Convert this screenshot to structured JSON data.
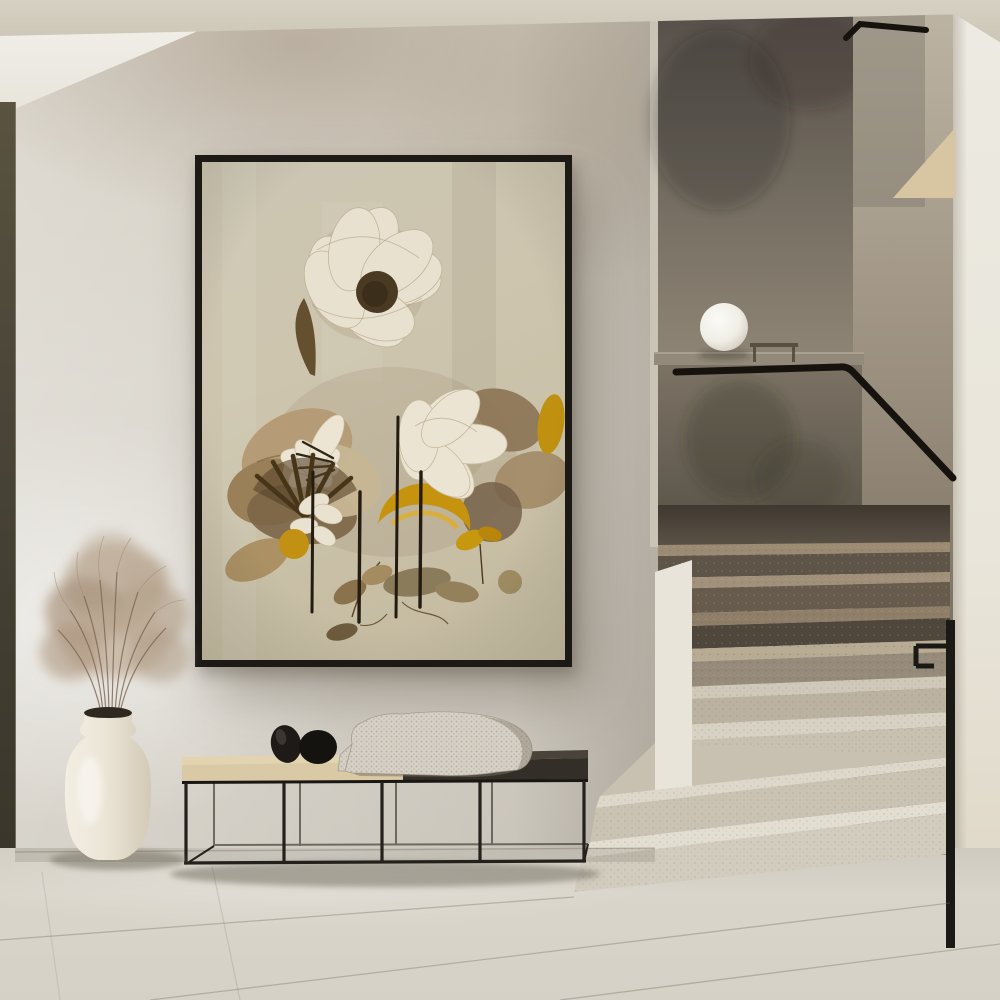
{
  "scene": {
    "description": "Minimalist beige interior hallway: large framed botanical art print on a plaster wall above a black metal bench, a cream ceramic vase with dried pampas grass on the floor, and a terrazzo staircase with a black handrail and a white globe lamp on the half-wall ledge",
    "wall_art": {
      "type": "framed botanical print",
      "frame": "thin black gallery frame",
      "motifs": [
        "large white ruffled flower with dark seed center",
        "dried tan and brown leaves",
        "golden yellow leaves",
        "dark thin stems",
        "dark fan-shaped seed pod",
        "scattered small leaves"
      ]
    },
    "bench": {
      "style": "low bench with thin black metal frame",
      "top": "two-tone: beige cushion on left, dark wood on right",
      "objects": [
        "black egg-shaped pebble sculpture",
        "black round pebble sculpture",
        "knitted beige throw blanket draped over edge"
      ]
    },
    "vase": {
      "style": "cream ceramic urn with narrow collared neck",
      "contents": "dried pampas grass plumes"
    },
    "staircase": {
      "steps": "terrazzo stone; cream lower steps widening toward floor, taupe upper steps",
      "handrail": "black metal rail, horizontal along landing then descending",
      "lamp": "white globe lamp on stair half-wall ledge",
      "walls": "dark textured plaster stairwell panels with beige ceiling wedge"
    },
    "floor": "large light grey-beige stone tiles",
    "left_edge": "dark olive door/window frame strip"
  },
  "palette": {
    "ceiling": "#d7d1c3",
    "wall": "#d8d4cb",
    "door": "#4a4538",
    "frame": "#1d1a16",
    "canvas": "#cdc5ae",
    "flower_white": "#e9e2d1",
    "leaf_brown": "#8a7355",
    "leaf_gold": "#c6930f",
    "stem": "#241c10",
    "bench_cushion": "#d9c9a4",
    "bench_dark": "#3a342c",
    "metal": "#1b1915",
    "blanket": "#d6d1c6",
    "vase": "#ece6d8",
    "grass": "#b5a28c",
    "step_light": "#ded8cb",
    "step_dark": "#5e5447",
    "stair_panel": "#6e665a",
    "right_wall": "#eceae2",
    "floor": "#d9d5cb",
    "lamp": "#f7f5ef"
  }
}
